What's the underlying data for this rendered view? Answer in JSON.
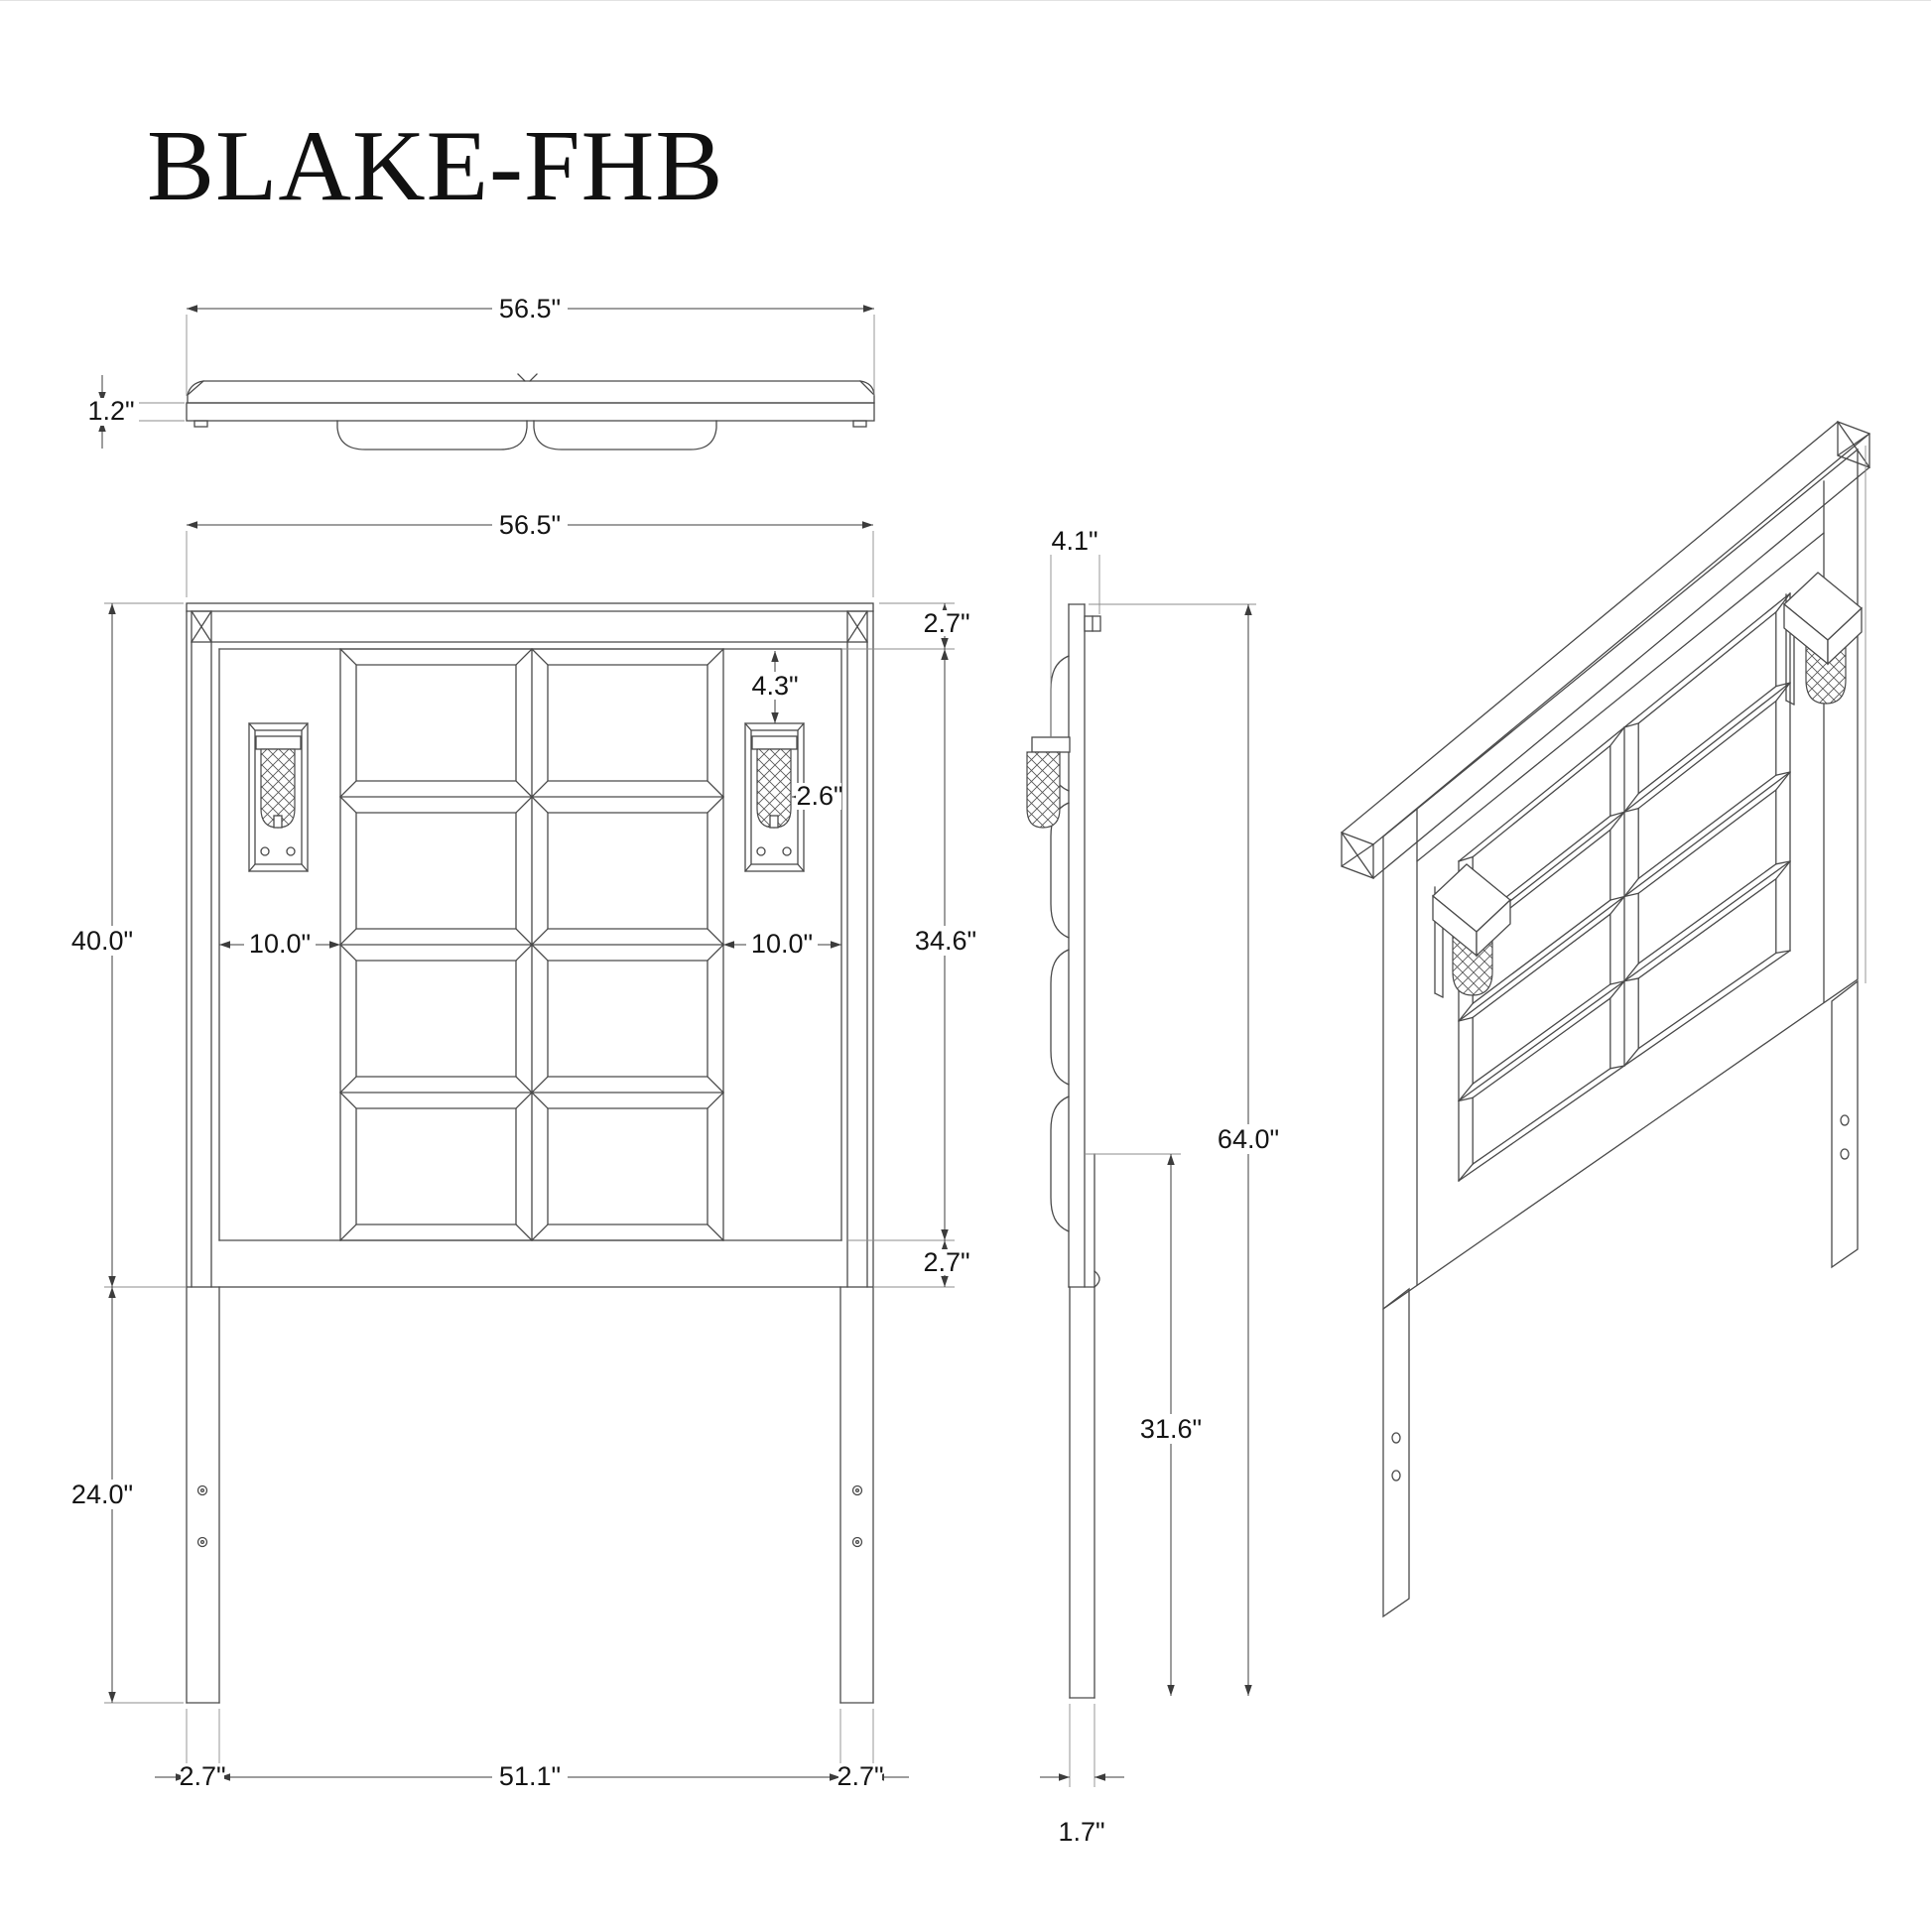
{
  "title": "BLAKE-FHB",
  "views": {
    "top": {
      "dims": {
        "width": "56.5\"",
        "thickness": "1.2\""
      }
    },
    "front": {
      "dims": {
        "width": "56.5\"",
        "top_rail": "2.7\"",
        "panel_drop": "4.3\"",
        "sconce_width": "2.6\"",
        "board_height": "40.0\"",
        "inset_left": "10.0\"",
        "inset_right": "10.0\"",
        "panel_height": "34.6\"",
        "bottom_rail": "2.7\"",
        "leg_height": "24.0\"",
        "leg_width_left": "2.7\"",
        "inner_width": "51.1\"",
        "leg_width_right": "2.7\""
      }
    },
    "side": {
      "dims": {
        "depth": "4.1\"",
        "total_height": "64.0\"",
        "mount_height": "31.6\"",
        "leg_thickness": "1.7\""
      }
    }
  }
}
